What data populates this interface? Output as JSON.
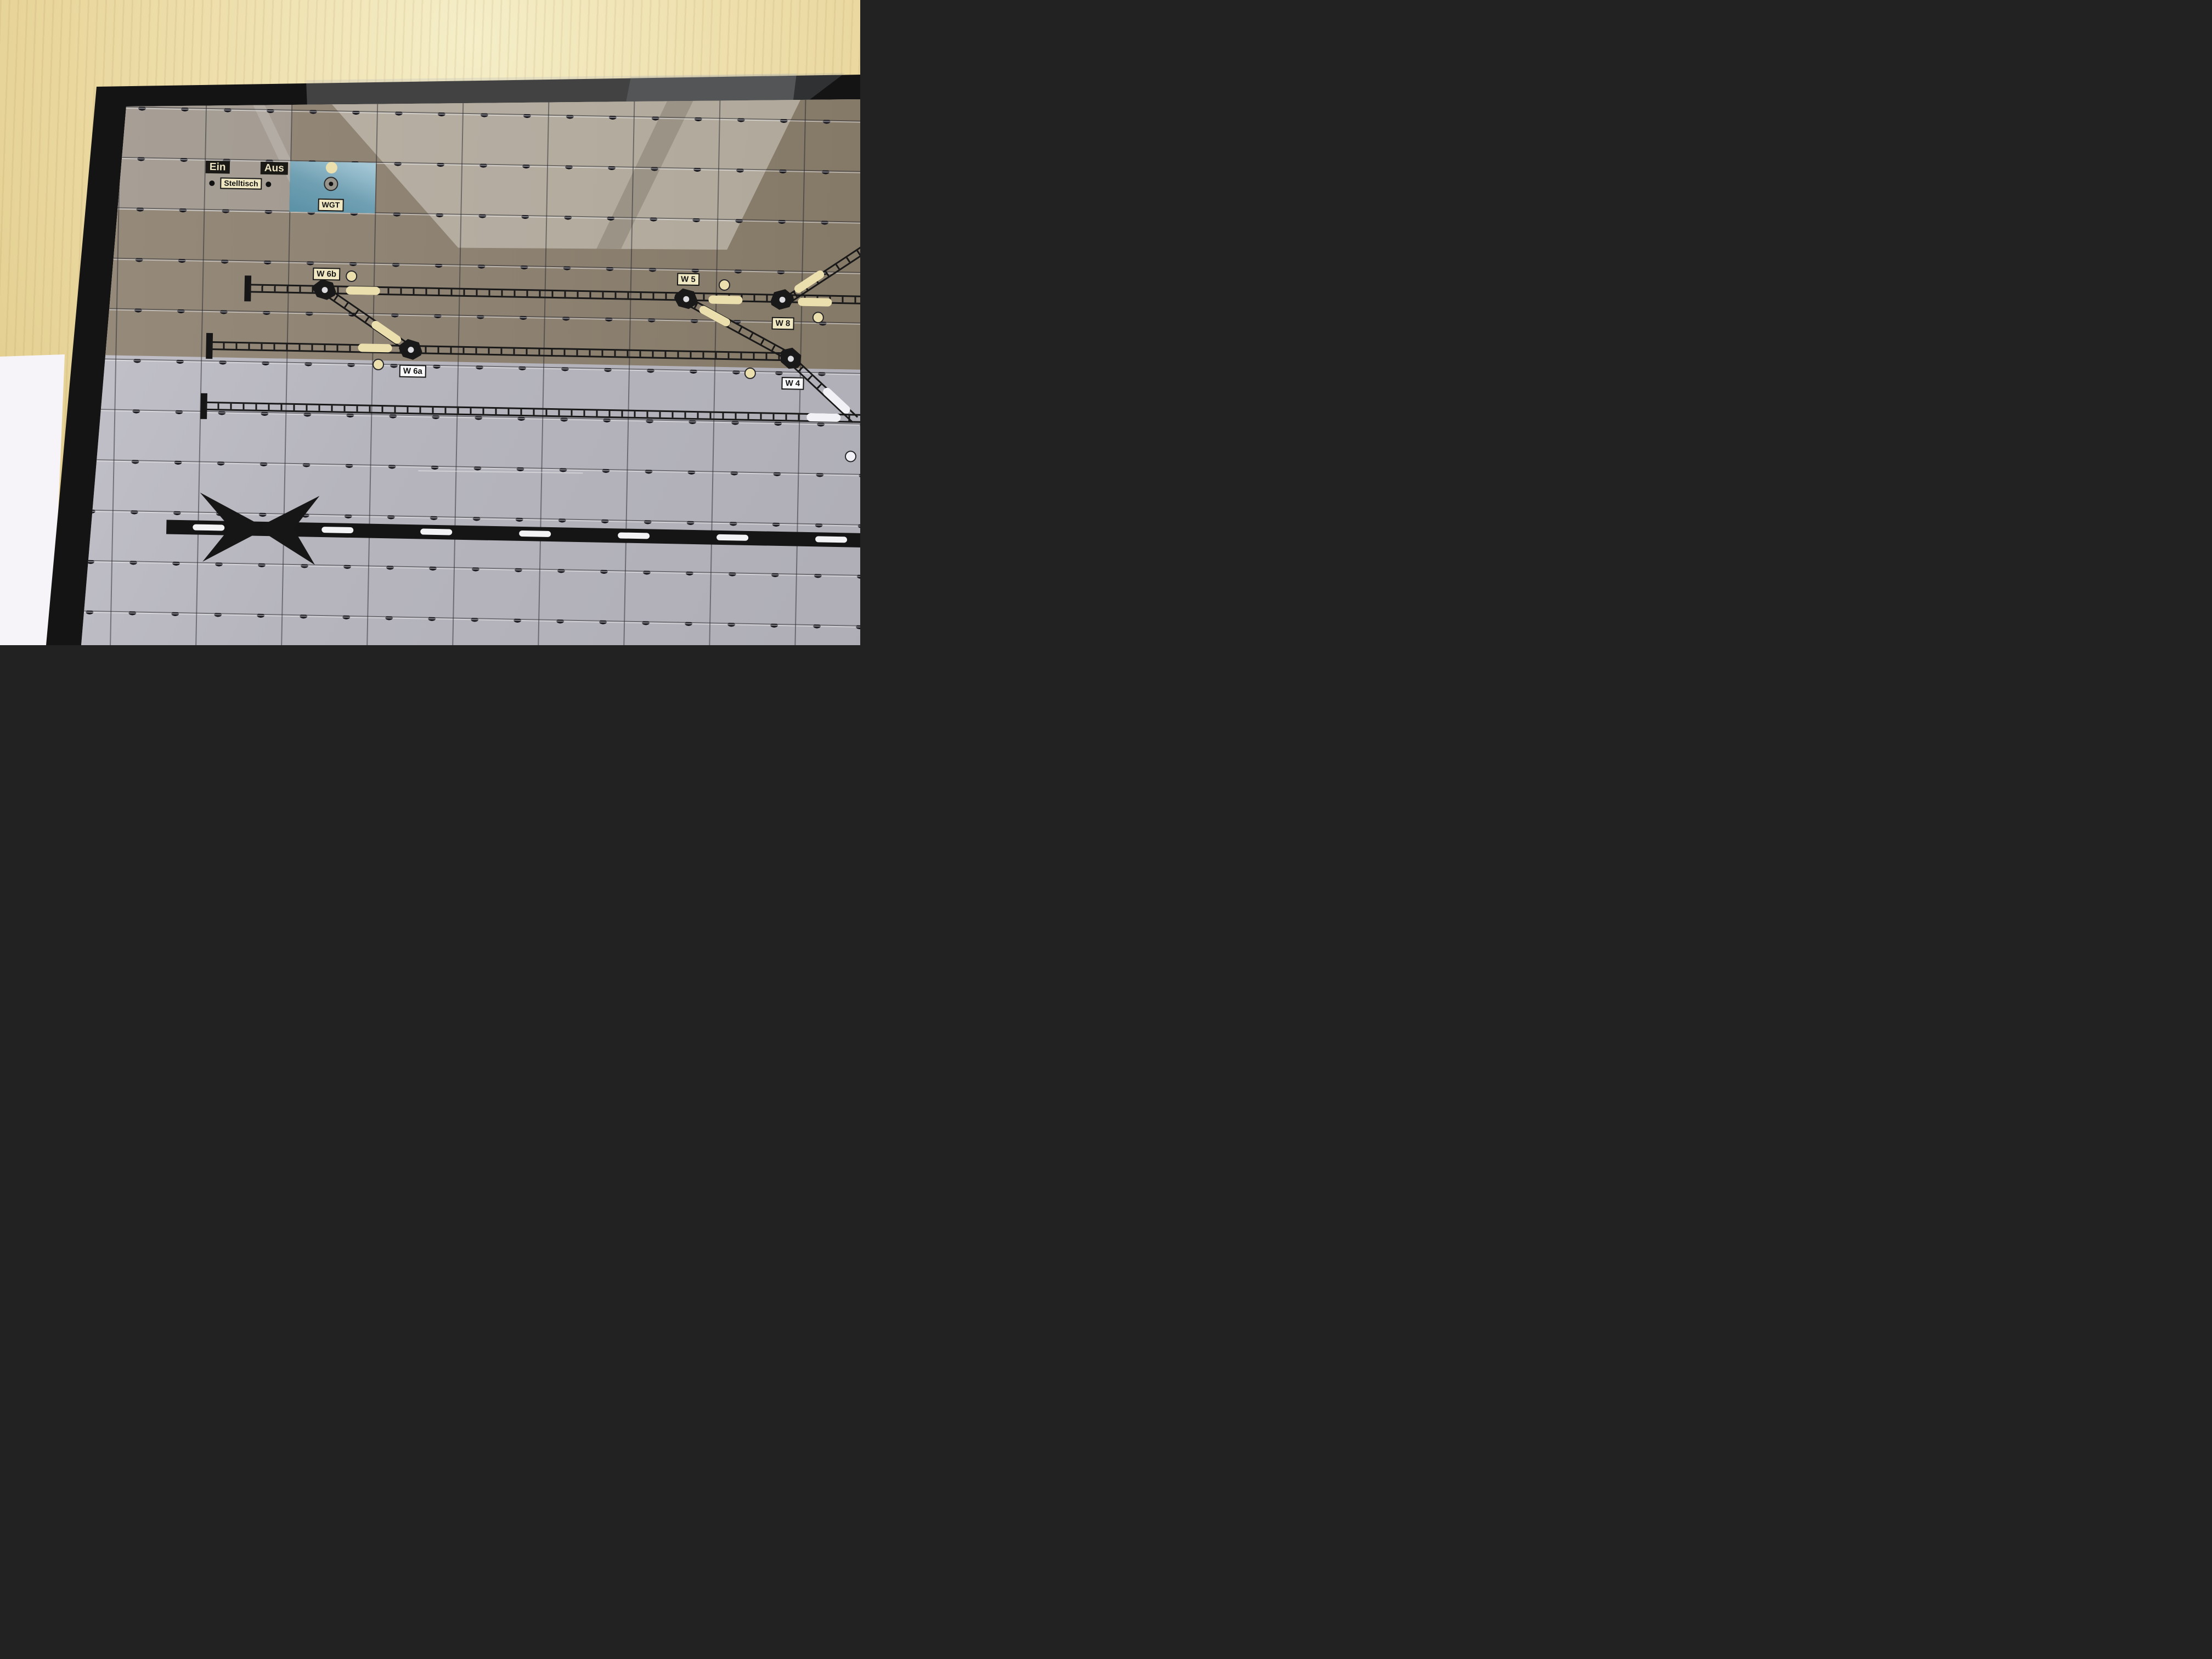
{
  "panel": {
    "power": {
      "on_label": "Ein",
      "off_label": "Aus",
      "panel_label": "Stelltisch"
    },
    "wgt": {
      "label": "WGT"
    },
    "turnouts": {
      "w6b": {
        "label": "W 6b"
      },
      "w6a": {
        "label": "W 6a"
      },
      "w5": {
        "label": "W 5"
      },
      "w8": {
        "label": "W 8"
      },
      "w4": {
        "label": "W 4"
      }
    },
    "colors": {
      "frame": "#141414",
      "wood_desk": "#ecddaa",
      "paper": "#f6f4f9",
      "tile_light": "#b6b5bd",
      "tile_shadow": "#8c8070",
      "tile_blue": "#74a4b8",
      "window_reflection": "#d9d5cc",
      "lamp_cream": "#ebdfad",
      "pill_white": "#f2f1f5",
      "label_bg": "#f0e8c2",
      "track": "#191919",
      "road": "#151515",
      "road_dash": "#f3f3f6"
    }
  }
}
